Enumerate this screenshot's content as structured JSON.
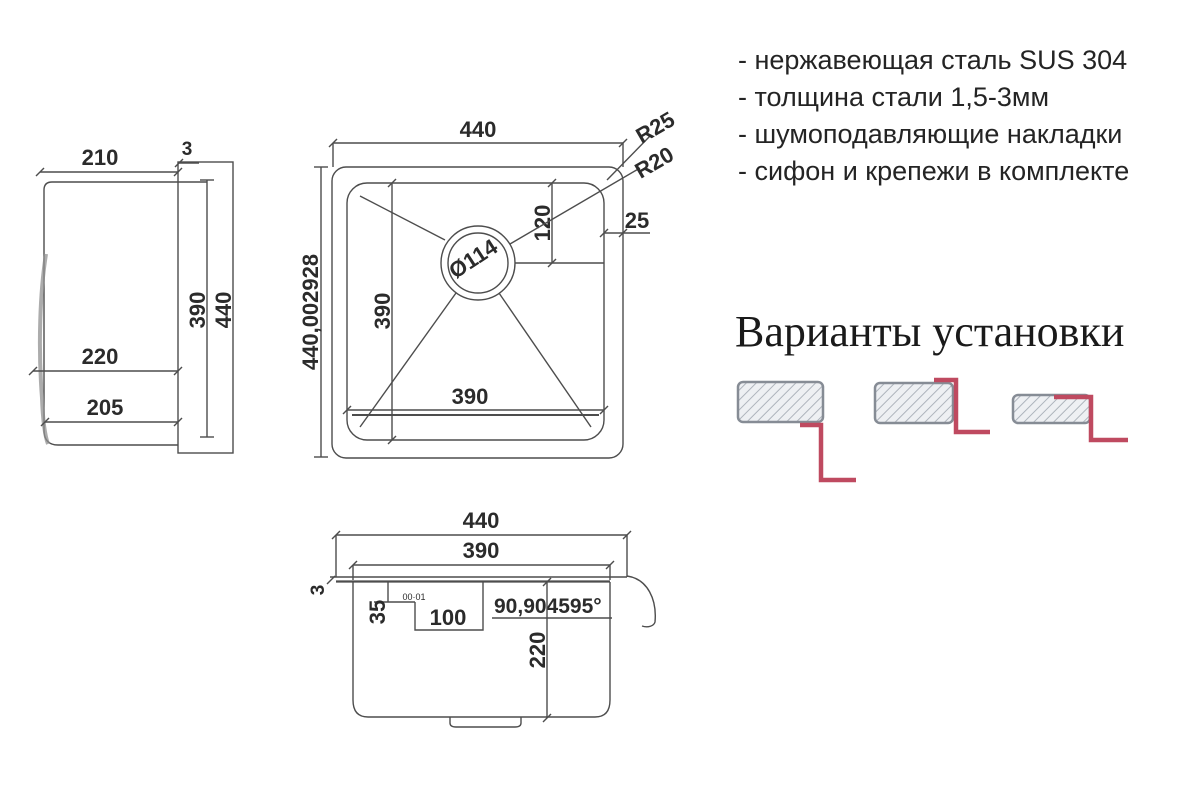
{
  "side_view": {
    "width_top": "210",
    "rim_thickness": "3",
    "inner_height": "390",
    "outer_height": "440",
    "depth_220": "220",
    "depth_205": "205"
  },
  "top_view": {
    "outer_width": "440",
    "corner_outer": "R25",
    "corner_inner": "R20",
    "rim_width": "25",
    "drain_offset": "120",
    "drain_diameter": "Ø114",
    "outer_height": "440,002928",
    "inner_height": "390",
    "inner_width": "390"
  },
  "front_view": {
    "outer_width": "440",
    "inner_width": "390",
    "rim_thickness": "3",
    "step_depth": "35",
    "tiny_marks": "00·01",
    "ledge_width": "100",
    "angle": "90,904595°",
    "bowl_depth": "220"
  },
  "specs": {
    "items": [
      "- нержавеющая сталь SUS 304",
      "- толщина стали 1,5-3мм",
      "- шумоподавляющие накладки",
      "- сифон и крепежи в комплекте"
    ]
  },
  "install": {
    "title": "Варианты установки"
  },
  "colors": {
    "line": "#4d4d4d",
    "text": "#2b2b2b",
    "accent_red": "#bf4a60",
    "hatch_border": "#868c95",
    "hatch_line": "#aeb4bc",
    "hatch_bg": "#eef0f3"
  }
}
